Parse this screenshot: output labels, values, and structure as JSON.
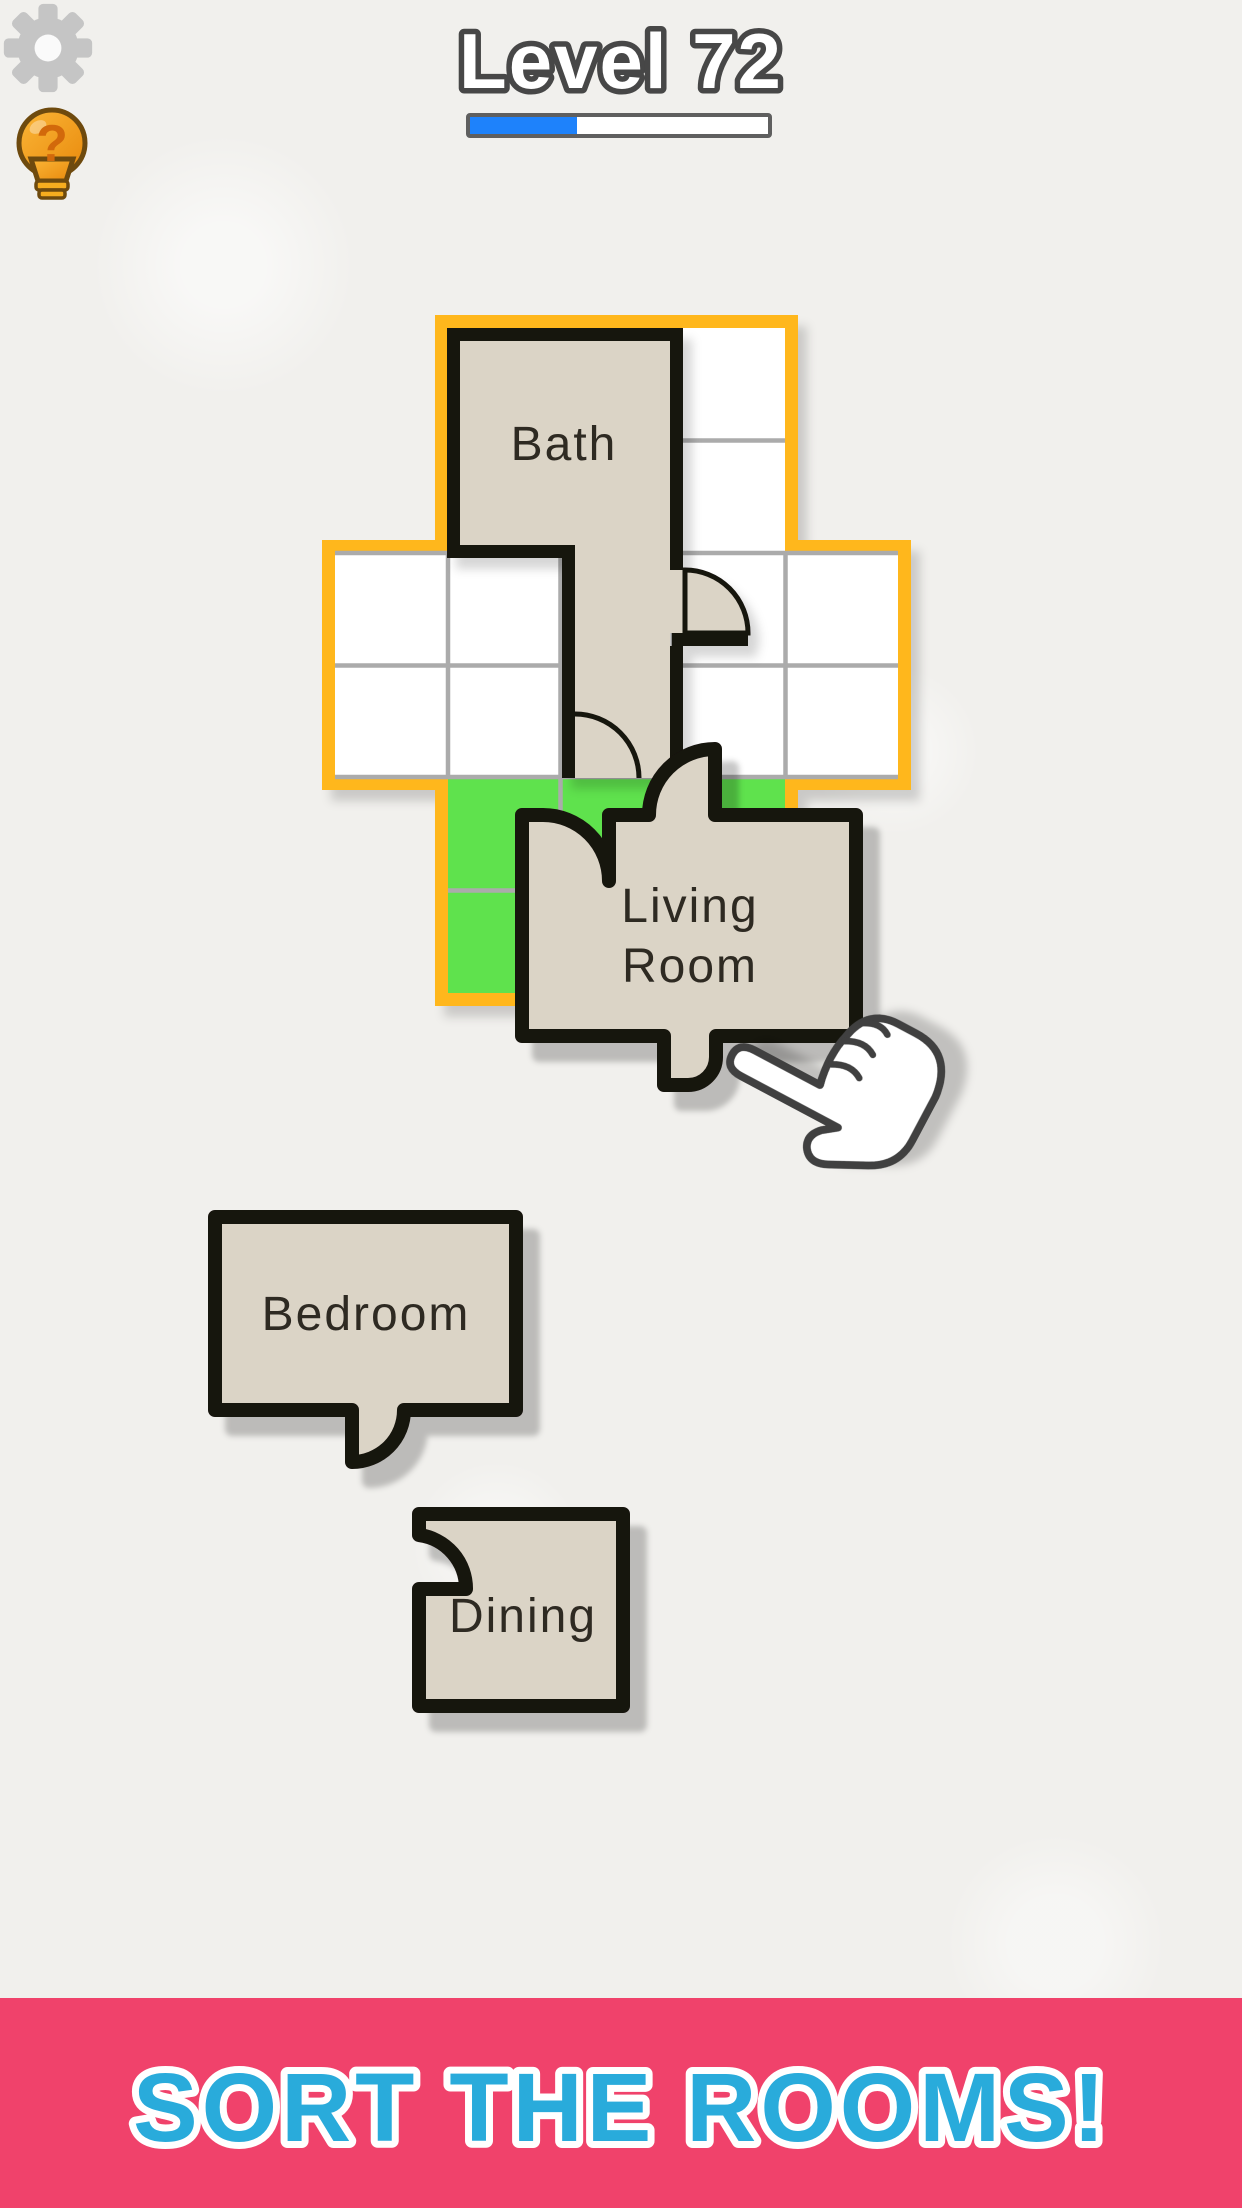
{
  "header": {
    "level_label": "Level 72",
    "progress_percent": 36,
    "settings_icon": "gear-icon",
    "hint_icon": "lightbulb-question-icon"
  },
  "board": {
    "shape": "cross-floor-plan",
    "colors": {
      "border": "#ffb71a",
      "cell": "#ffffff",
      "grid_line": "#ababab",
      "highlight": "#5fe24d",
      "room_fill": "#dbd4c6",
      "wall": "#17120e"
    }
  },
  "pieces": {
    "bath": {
      "label": "Bath",
      "state": "placed"
    },
    "living_room": {
      "label": "Living Room",
      "line1": "Living",
      "line2": "Room",
      "state": "dragging"
    },
    "bedroom": {
      "label": "Bedroom",
      "state": "unplaced"
    },
    "dining": {
      "label": "Dining",
      "state": "unplaced"
    }
  },
  "banner": {
    "text": "SORT THE ROOMS!",
    "bg_color": "#f0426b",
    "text_color": "#29abdb"
  },
  "cursor": "hand-pointer-cursor"
}
